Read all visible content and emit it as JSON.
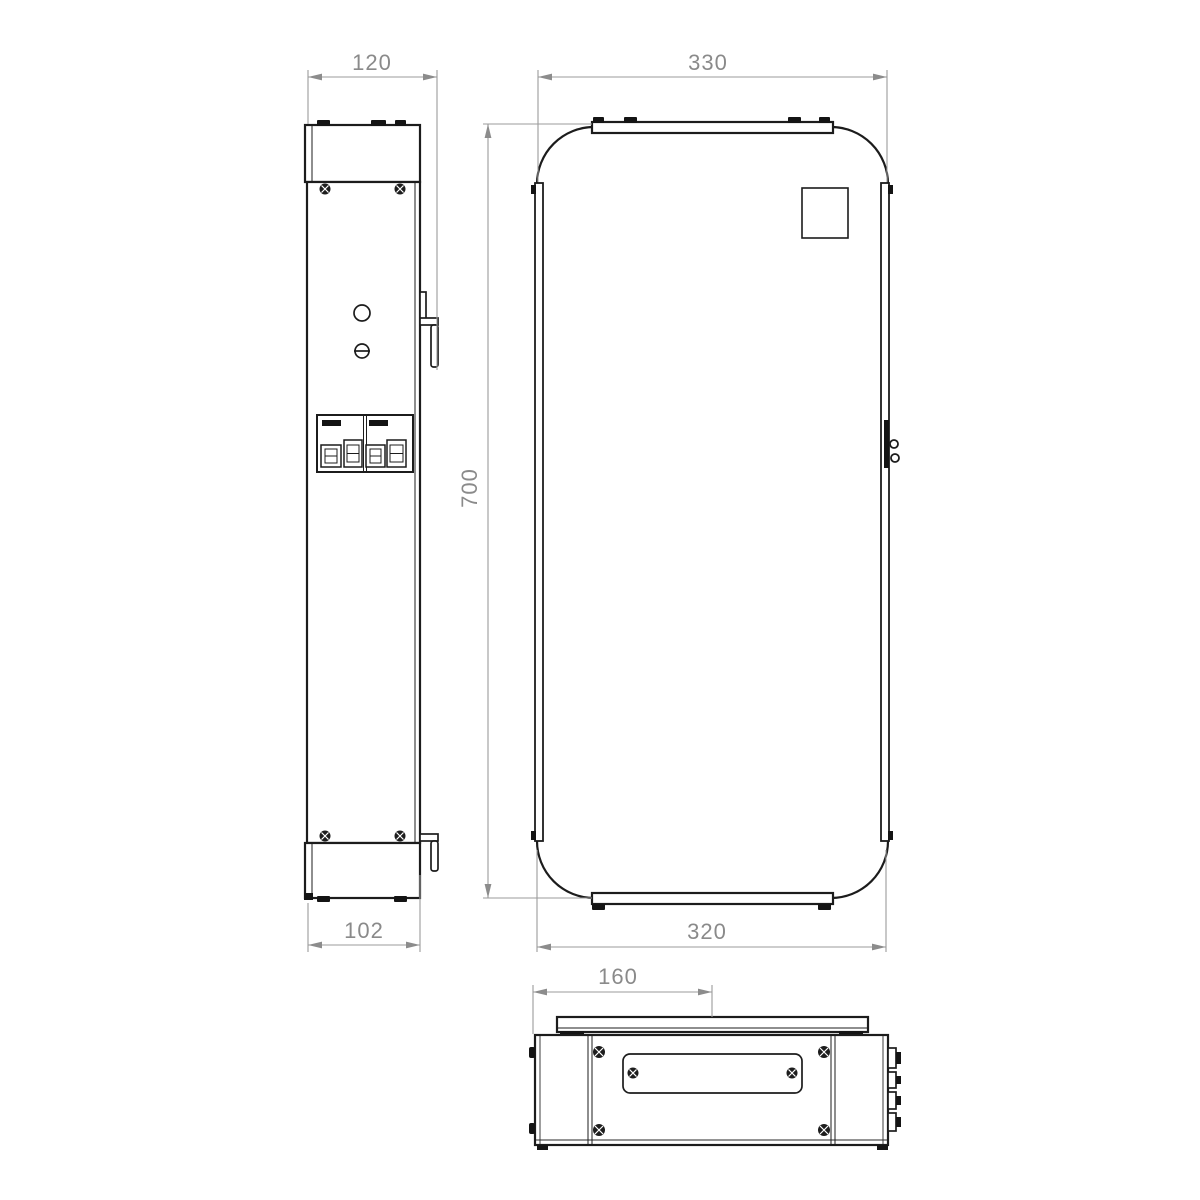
{
  "canvas": {
    "background": "#ffffff"
  },
  "colors": {
    "drawing_line": "#1c1c1c",
    "dimension_line": "#9b9b9b",
    "dimension_text": "#8a8a8a"
  },
  "views": {
    "side": {
      "dimensions": {
        "depth_overall": "120",
        "depth_body": "102"
      }
    },
    "front": {
      "dimensions": {
        "width_top": "330",
        "height": "700",
        "width_bottom": "320"
      }
    },
    "bottom": {
      "dimensions": {
        "mount_offset": "160"
      }
    }
  }
}
